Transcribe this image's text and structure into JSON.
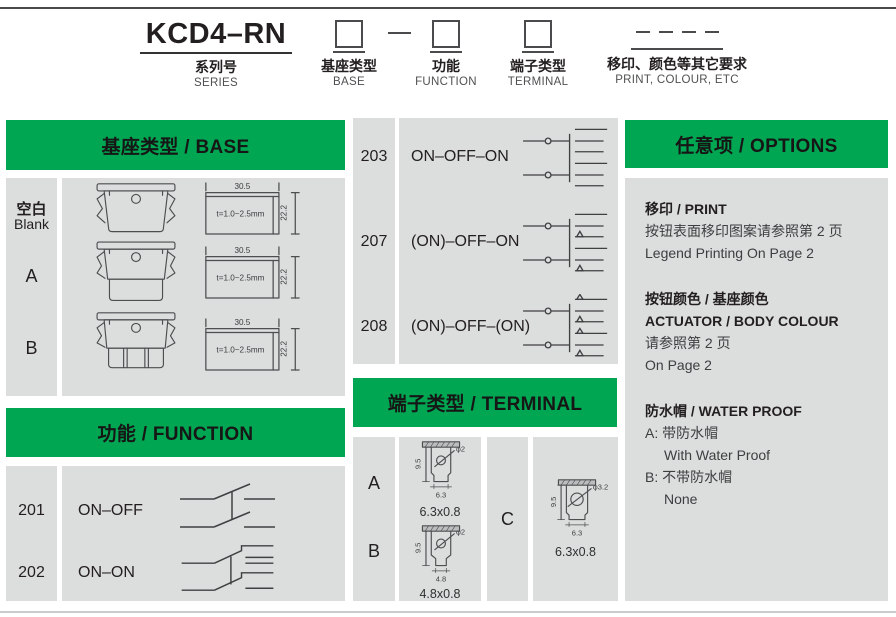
{
  "colors": {
    "accent_green": "#00a651",
    "panel_gray": "#dcdddd"
  },
  "code_builder": {
    "series": {
      "code": "KCD4–RN",
      "zh": "系列号",
      "en": "SERIES"
    },
    "base": {
      "zh": "基座类型",
      "en": "BASE"
    },
    "function": {
      "zh": "功能",
      "en": "FUNCTION"
    },
    "terminal": {
      "zh": "端子类型",
      "en": "TERMINAL"
    },
    "print": {
      "zh": "移印、颜色等其它要求",
      "en": "PRINT, COLOUR, ETC"
    }
  },
  "base_section": {
    "title": "基座类型 / BASE",
    "rows": [
      {
        "label_zh": "空白",
        "label_en": "Blank"
      },
      {
        "label": "A"
      },
      {
        "label": "B"
      }
    ],
    "dims": {
      "width": "30.5",
      "height": "22.2",
      "thickness": "t=1.0~2.5mm"
    }
  },
  "function_section": {
    "title": "功能 / FUNCTION",
    "rows": [
      {
        "code": "201",
        "label": "ON–OFF"
      },
      {
        "code": "202",
        "label": "ON–ON"
      }
    ],
    "rows2": [
      {
        "code": "203",
        "label": "ON–OFF–ON"
      },
      {
        "code": "207",
        "label": "(ON)–OFF–ON"
      },
      {
        "code": "208",
        "label": "(ON)–OFF–(ON)"
      }
    ]
  },
  "terminal_section": {
    "title": "端子类型 / TERMINAL",
    "items": [
      {
        "code": "A",
        "height": "9.5",
        "width": "6.3",
        "hole": "φ2",
        "size": "6.3x0.8"
      },
      {
        "code": "B",
        "height": "9.5",
        "width": "4.8",
        "hole": "φ2",
        "size": "4.8x0.8"
      },
      {
        "code": "C",
        "height": "9.5",
        "width": "6.3",
        "hole": "φ3.2",
        "size": "6.3x0.8"
      }
    ]
  },
  "options_section": {
    "title": "任意项 / OPTIONS",
    "print_heading": "移印 / PRINT",
    "print_zh": "按钮表面移印图案请参照第 2 页",
    "print_en": "Legend Printing On Page 2",
    "colour_heading_zh": "按钮颜色 / 基座颜色",
    "colour_heading_en": "ACTUATOR / BODY COLOUR",
    "colour_zh": "请参照第 2 页",
    "colour_en": "On Page 2",
    "waterproof_heading": "防水帽 / WATER PROOF",
    "waterproof_a_zh": "A: 带防水帽",
    "waterproof_a_en": "With Water Proof",
    "waterproof_b_zh": "B: 不带防水帽",
    "waterproof_b_en": "None"
  }
}
